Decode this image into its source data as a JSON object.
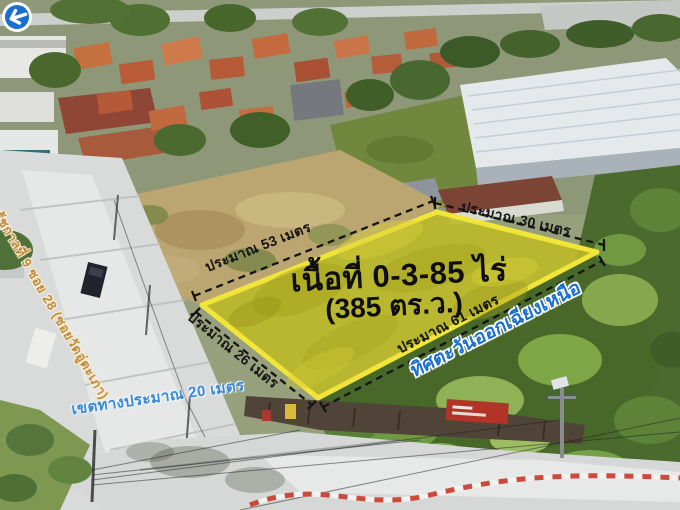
{
  "photo_description": "Aerial drone photo of a vacant land plot for sale, highlighted in yellow with measurements",
  "plot": {
    "area_line1": "เนื้อที่ 0-3-85 ไร่",
    "area_line2": "(385 ตร.ว.)",
    "edges": {
      "nw": "ประมาณ 53 เมตร",
      "ne": "ประมาณ 30 เมตร",
      "sw": "ประมาณ 26 เมตร",
      "se": "ประมาณ 61 เมตร"
    },
    "highlight_color": "#bdb927",
    "rim_color": "#f2e53a",
    "measure_line_color": "#141414"
  },
  "annotations": {
    "direction": "ทิศตะวันออกเฉียงเหนือ",
    "direction_color": "#1a6fd0",
    "direction_icon": "circle-left-arrow",
    "road_name": "ถนนเฉลิมรัชกาลที่ 9 ซอย 28 (ซอยวัดอู่ตะเภา)",
    "road_name_color": "#bf8b3f",
    "road_width": "เขตทางประมาณ 20 เมตร",
    "road_width_color": "#3b87d2"
  }
}
